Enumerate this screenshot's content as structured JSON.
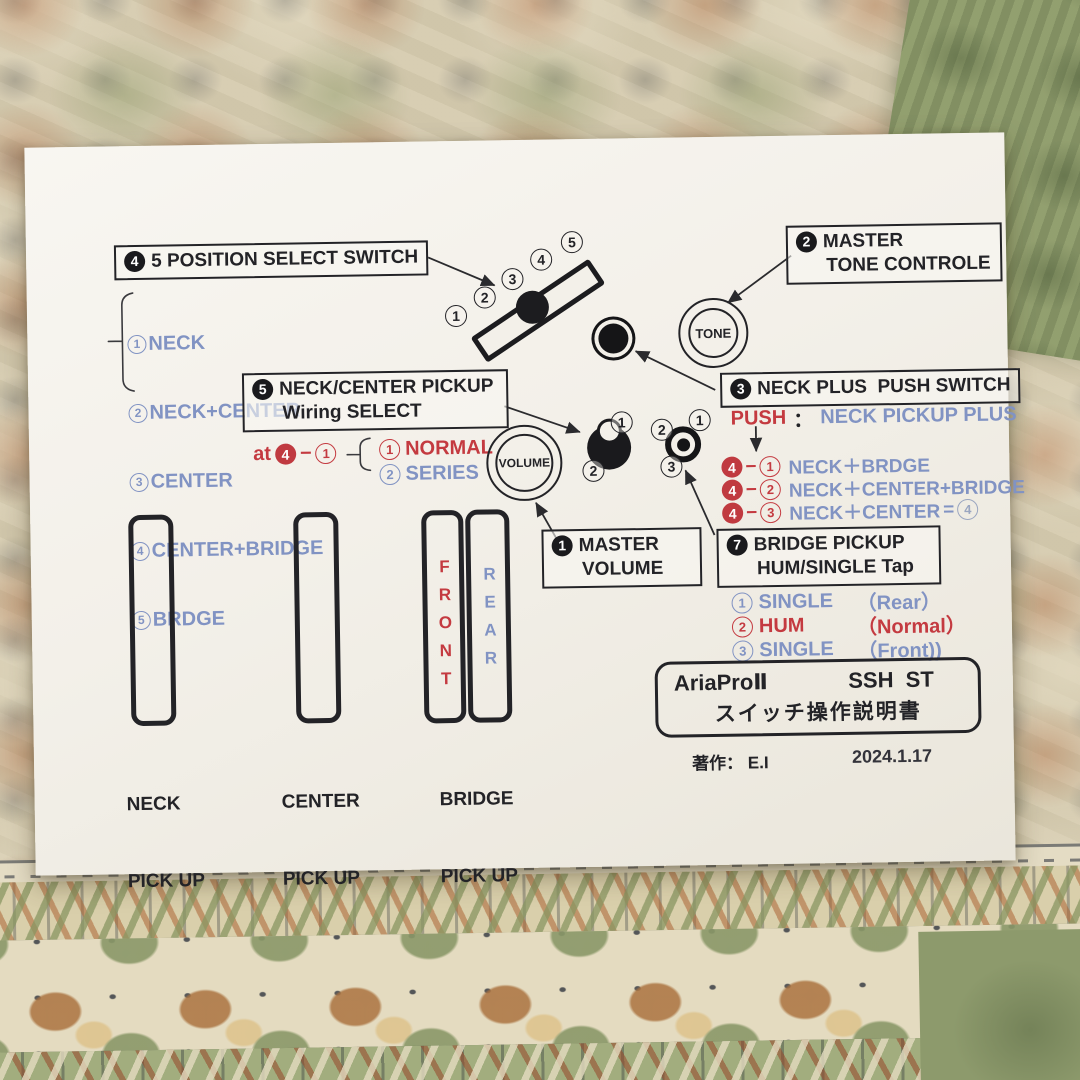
{
  "colors": {
    "blue": "#8193c3",
    "red": "#c43a40",
    "ink": "#232327",
    "paper": "#f3f0e9"
  },
  "sw5": {
    "num": "4",
    "title": "5 POSITION SELECT SWITCH",
    "items": [
      {
        "n": "1",
        "label": "NECK"
      },
      {
        "n": "2",
        "label": "NECK+CENTER"
      },
      {
        "n": "3",
        "label": "CENTER"
      },
      {
        "n": "4",
        "label": "CENTER+BRIDGE"
      },
      {
        "n": "5",
        "label": "BRDGE"
      }
    ]
  },
  "switch_positions": [
    "1",
    "2",
    "3",
    "4",
    "5"
  ],
  "tone_box": {
    "num": "2",
    "line1": "MASTER",
    "line2": "TONE CONTROLE"
  },
  "knobs": {
    "tone": "TONE",
    "volume": "VOLUME"
  },
  "neck_plus": {
    "num": "3",
    "title": "NECK PLUS  PUSH SWITCH",
    "push": "PUSH",
    "colon": "：",
    "value": "NECK PICKUP PLUS",
    "combos": [
      {
        "k": "4",
        "dash": "−",
        "p": "1",
        "result": "NECK＋BRDGE"
      },
      {
        "k": "4",
        "dash": "−",
        "p": "2",
        "result": "NECK＋CENTER+BRIDGE"
      },
      {
        "k": "4",
        "dash": "−",
        "p": "3",
        "result": "NECK＋CENTER",
        "equals": "=",
        "eq_circle": "4"
      }
    ]
  },
  "wiring": {
    "num": "5",
    "line1": "NECK/CENTER PICKUP",
    "line2": "Wiring SELECT",
    "at": "at",
    "at_k": "4",
    "at_dash": "−",
    "at_p": "1",
    "options": [
      {
        "p": "1",
        "label": "NORMAL"
      },
      {
        "p": "2",
        "label": "SERIES"
      }
    ]
  },
  "volume_box": {
    "num": "1",
    "line1": "MASTER",
    "line2": "VOLUME"
  },
  "bridge_tap": {
    "num": "7",
    "line1": "BRIDGE PICKUP",
    "line2": "HUM/SINGLE Tap",
    "options": [
      {
        "p": "1",
        "label": "SINGLE",
        "paren": "（Rear）"
      },
      {
        "p": "2",
        "label": "HUM",
        "paren": "（Normal）"
      },
      {
        "p": "3",
        "label": "SINGLE",
        "paren": "（Front))"
      }
    ]
  },
  "pot_markers": {
    "wiring": [
      "1",
      "2"
    ],
    "tap": [
      "2",
      "1",
      "3"
    ]
  },
  "pickups": {
    "neck": {
      "line1": "NECK",
      "line2": "PICK UP"
    },
    "center": {
      "line1": "CENTER",
      "line2": "PICK UP"
    },
    "bridge": {
      "line1": "BRIDGE",
      "line2": "PICK UP"
    },
    "front": "FRONT",
    "rear": "REAR"
  },
  "title_box": {
    "model": "AriaProⅡ",
    "code": "SSH  ST",
    "subtitle": "スイッチ操作説明書"
  },
  "credit": {
    "author": "著作： E.I",
    "date": "2024.1.17"
  }
}
